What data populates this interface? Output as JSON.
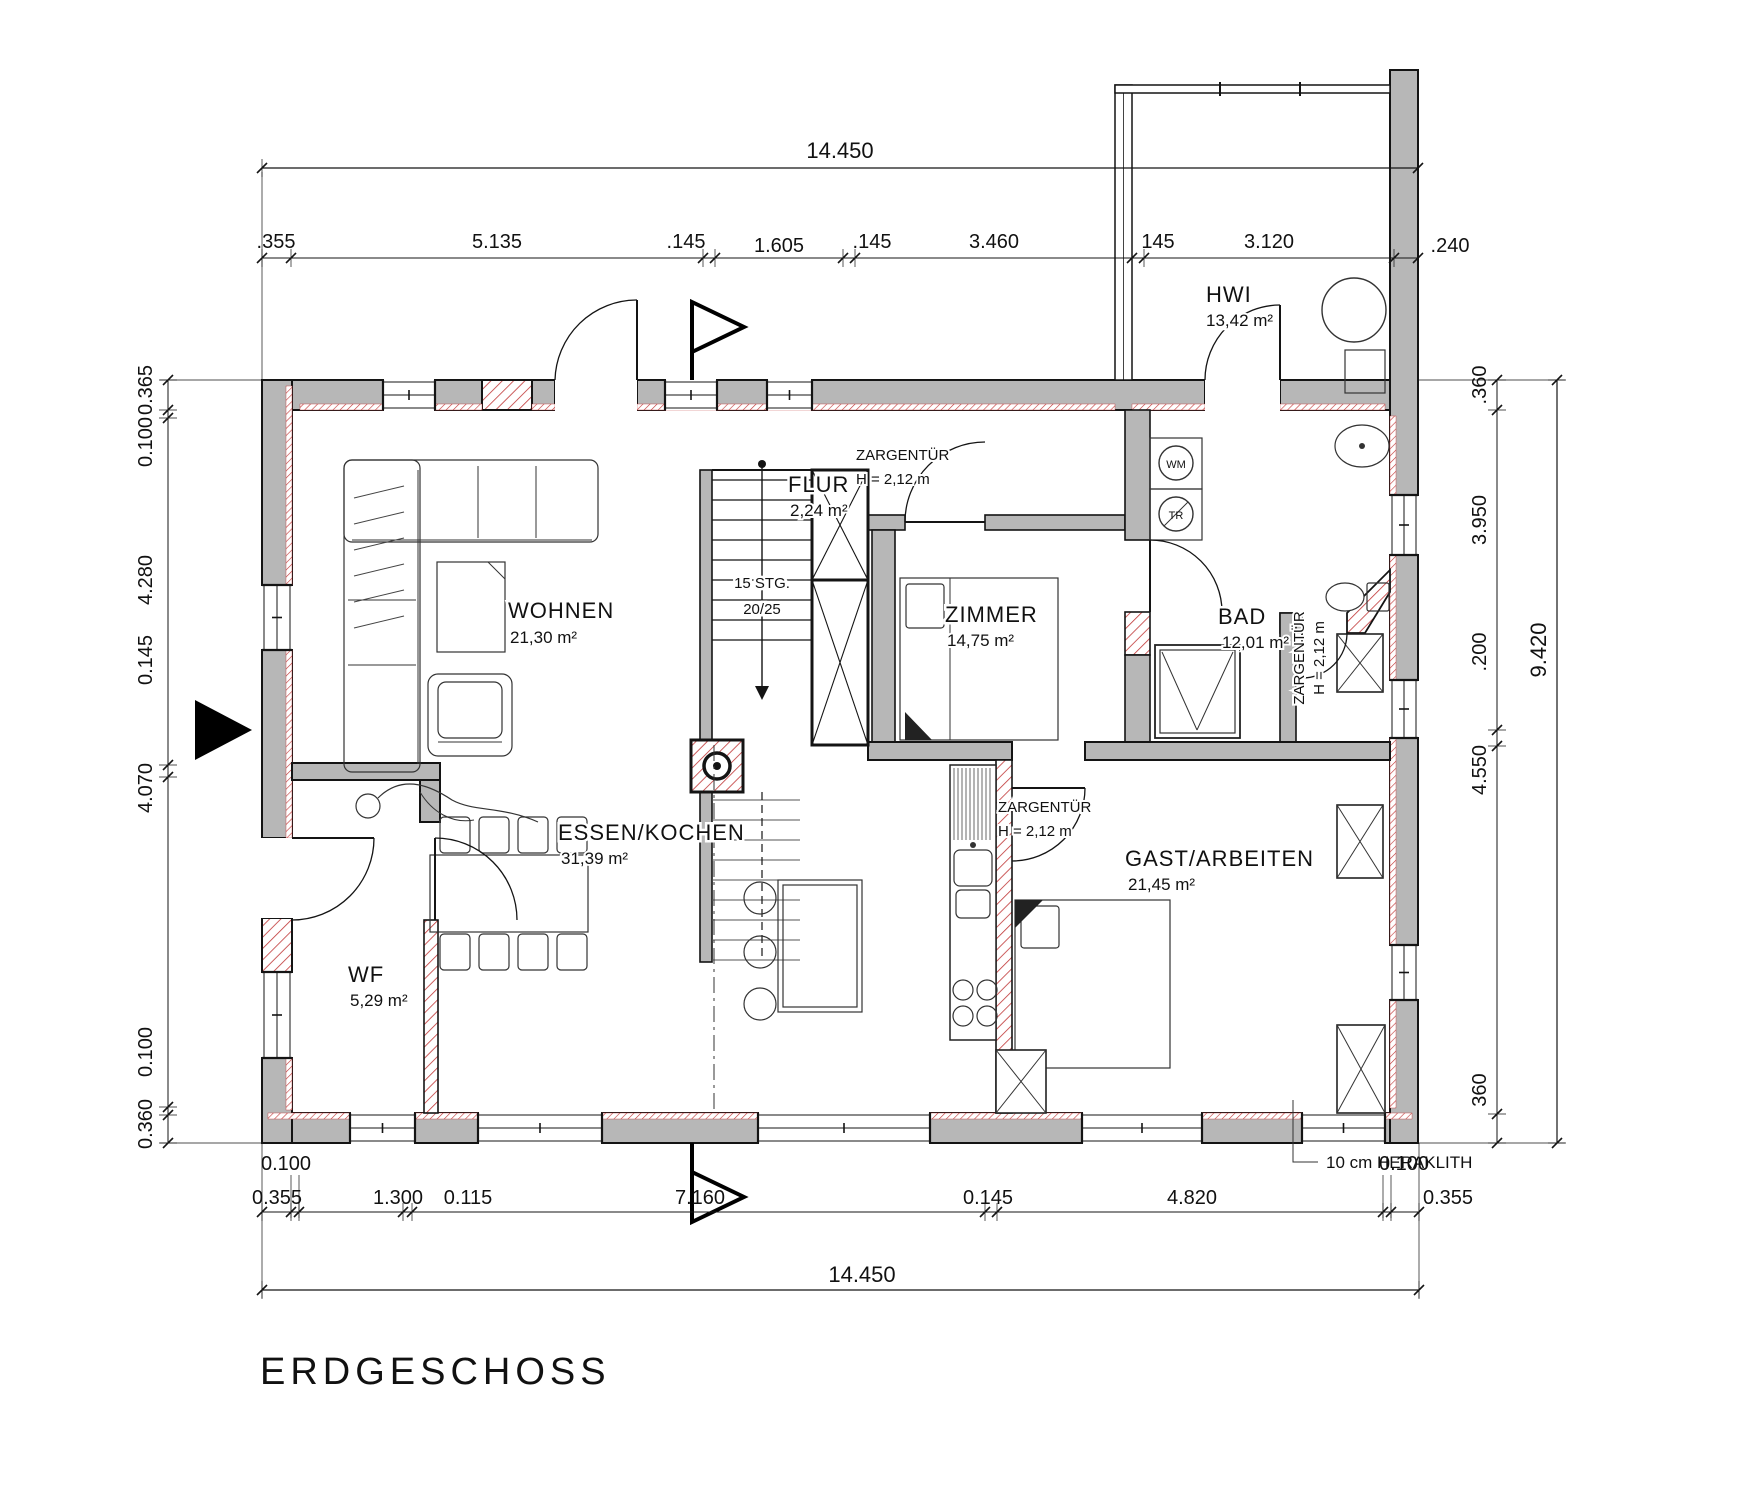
{
  "title": "ERDGESCHOSS",
  "rooms": {
    "wohnen": {
      "name": "WOHNEN",
      "area": "21,30 m²"
    },
    "essen": {
      "name": "ESSEN/KOCHEN",
      "area": "31,39 m²"
    },
    "wf": {
      "name": "WF",
      "area": "5,29 m²"
    },
    "flur": {
      "name": "FLUR",
      "area": "2,24 m²"
    },
    "zimmer": {
      "name": "ZIMMER",
      "area": "14,75 m²"
    },
    "bad": {
      "name": "BAD",
      "area": "12,01 m²"
    },
    "gast": {
      "name": "GAST/ARBEITEN",
      "area": "21,45 m²"
    },
    "hwi": {
      "name": "HWI",
      "area": "13,42 m²"
    }
  },
  "stairs": {
    "line1": "15 STG.",
    "line2": "20/25"
  },
  "appliances": {
    "wm": "WM",
    "tr": "TR"
  },
  "annotations": {
    "zargen_flur": {
      "l1": "ZARGENTÜR",
      "l2": "H = 2,12 m"
    },
    "zargen_gast": {
      "l1": "ZARGENTÜR",
      "l2": "H = 2,12 m"
    },
    "zargen_bad": {
      "l1": "ZARGENTÜR",
      "l2": "H = 2,12 m"
    },
    "heraklith": "10 cm HERAKLITH"
  },
  "dimensions": {
    "top_total": "14.450",
    "top": [
      ".355",
      "5.135",
      ".145",
      "1.605",
      ".145",
      "3.460",
      "145",
      "3.120",
      ".240"
    ],
    "left": [
      "0.365",
      "0.100",
      "4.280",
      "0.145",
      "4.070",
      "0.100",
      "0.360"
    ],
    "right": [
      ".360",
      "3.950",
      ".200",
      "4.550",
      "360"
    ],
    "right_total": "9.420",
    "bottom": [
      "0.355",
      "0.100",
      "1.300",
      "0.115",
      "7.160",
      "0.145",
      "4.820",
      "0.100",
      "0.355"
    ],
    "bottom_total": "14.450"
  },
  "colors": {
    "wall_fill": "#b7b7b7",
    "insulation_red": "#c03636",
    "line": "#141414"
  }
}
